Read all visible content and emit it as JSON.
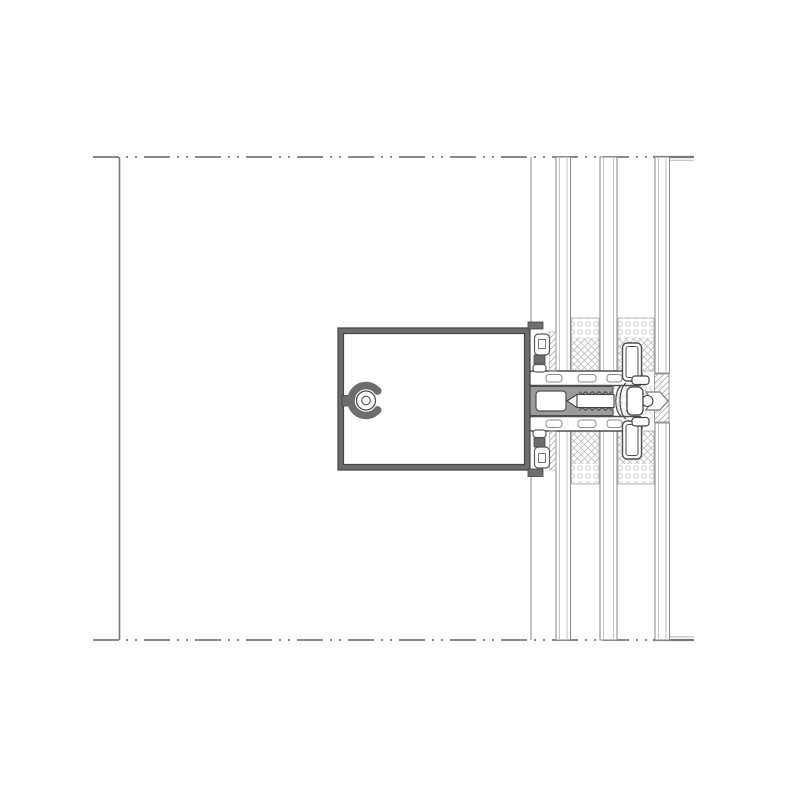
{
  "drawing": {
    "kind": "technical-cad-section-detail",
    "subject": "curtain-wall transom / mullion glazing section with triple insulated glazing, toggle fixing screw and edge seals",
    "background": "#ffffff",
    "colors": {
      "aluminum_fill": "#6d6d6d",
      "aluminum_dark": "#454545",
      "profile_stroke": "#4f4f4f",
      "line_medium": "#8a8a8a",
      "line_dark": "#444444",
      "line_soft": "#9a9a9a",
      "line_faint": "#b5b5b5",
      "pane_edge": "#8f8f8f",
      "pane_inner": "#c2c2c2",
      "hatch": "#bdbdbd",
      "dots": "#c9c9c9",
      "channel_fill": "#9b9b9b",
      "white": "#ffffff"
    },
    "canvas": {
      "width": 800,
      "height": 800
    },
    "reference_lines": {
      "top_centerline_y": 157,
      "bottom_centerline_y": 640,
      "centerline_x1": 93,
      "centerline_x2": 650,
      "dash_pattern": "26 7 2 7 2 7",
      "solid_cap_x1": 653,
      "solid_cap_x2": 694,
      "interior_line_x": 119.5,
      "mullion_face_line_x": 531
    },
    "glazing": {
      "pane_names": [
        "inner-pane",
        "middle-pane",
        "outer-pane"
      ],
      "panes": [
        {
          "x1": 556,
          "x2": 570.5,
          "segments": [
            [
              157,
              371
            ],
            [
              431,
              640
            ]
          ]
        },
        {
          "x1": 600,
          "x2": 617,
          "segments": [
            [
              157,
              371
            ],
            [
              431,
              640
            ]
          ]
        },
        {
          "x1": 655,
          "x2": 669.5,
          "segments": [
            [
              157,
              373
            ],
            [
              423,
              640
            ]
          ]
        }
      ],
      "spacer_zones": [
        {
          "x": 571.5,
          "w": 27.5,
          "dots": [
            318,
            20
          ],
          "hatch": [
            338,
            33
          ],
          "zone": [
            318,
            53
          ]
        },
        {
          "x": 618,
          "w": 36,
          "dots": [
            318,
            20
          ],
          "hatch": [
            338,
            33
          ],
          "zone": [
            318,
            53
          ]
        },
        {
          "x": 571.5,
          "w": 27.5,
          "dots": [
            464,
            20
          ],
          "hatch": [
            431,
            33
          ],
          "zone": [
            431,
            53
          ]
        },
        {
          "x": 618,
          "w": 36,
          "dots": [
            464,
            20
          ],
          "hatch": [
            431,
            33
          ],
          "zone": [
            431,
            53
          ]
        }
      ]
    },
    "transom_profile": {
      "box": {
        "x": 338,
        "y": 328,
        "w": 192,
        "h": 142,
        "wall": 5.5
      },
      "top_lip": [
        528,
        322,
        15,
        7
      ],
      "bottom_lip": [
        528,
        469,
        15,
        7.5
      ],
      "screw_boss": {
        "cx": 366,
        "cy": 400.5,
        "ring_r": 15,
        "ring_w": 7.5,
        "gap_deg": 80,
        "hole_r": 9.5,
        "pilot_r": 4.3,
        "stem": [
          342,
          395.5,
          10,
          10.5
        ]
      }
    },
    "glazing_rebate": {
      "upper_bar": [
        529,
        371,
        113,
        14.5
      ],
      "lower_bar": [
        529,
        416.5,
        113,
        14.5
      ],
      "bar_slots_x": [
        [
          546,
          16
        ],
        [
          578,
          18
        ],
        [
          607,
          15
        ]
      ],
      "upper_slot_y": 374.5,
      "lower_slot_y": 420,
      "gaskets_upper": {
        "bulb_a": [
          534.5,
          334,
          15,
          21
        ],
        "hole_a": [
          538.5,
          339.5,
          7,
          9
        ],
        "tab": [
          534,
          355,
          11,
          9
        ],
        "bulb_b": [
          533,
          364.5,
          13,
          7.5
        ],
        "hatch_sliver": [
          549.5,
          332,
          6.5,
          39
        ]
      },
      "gaskets_lower": {
        "bulb_a": [
          534.5,
          447,
          15,
          21
        ],
        "hole_a": [
          538.5,
          453.5,
          7,
          9
        ],
        "tab": [
          534,
          438,
          11,
          9
        ],
        "bulb_b": [
          533,
          430,
          13,
          7.5
        ],
        "hatch_sliver": [
          549.5,
          431,
          6.5,
          39
        ]
      }
    },
    "fixing": {
      "channel": [
        529,
        386.5,
        84,
        29
      ],
      "chamber": [
        536,
        391,
        30,
        20
      ],
      "screw_tip": [
        [
          567,
          401
        ],
        [
          577,
          394.5
        ],
        [
          577,
          407.5
        ]
      ],
      "screw_shank": [
        577,
        394.5,
        37,
        13
      ],
      "washer_head": [
        627,
        387,
        16,
        28
      ],
      "notch_circle": [
        647.5,
        401,
        5.5
      ],
      "hook_upper": [
        632,
        376,
        17,
        8.5
      ],
      "hook_lower": [
        632,
        417.5,
        17,
        8.5
      ],
      "toggle_arm_upper": [
        622.5,
        343,
        19,
        38
      ],
      "toggle_arm_lower": [
        622.5,
        421,
        19,
        38
      ]
    },
    "joint": {
      "foam_dots": [
        604,
        383,
        48,
        36
      ],
      "sealant_bowtie": [
        654.5,
        374,
        14.5,
        48
      ],
      "chevron": [
        [
          646,
          392
        ],
        [
          660,
          392
        ],
        [
          668,
          401
        ],
        [
          660,
          410
        ],
        [
          646,
          410
        ],
        [
          652,
          401
        ]
      ]
    }
  }
}
